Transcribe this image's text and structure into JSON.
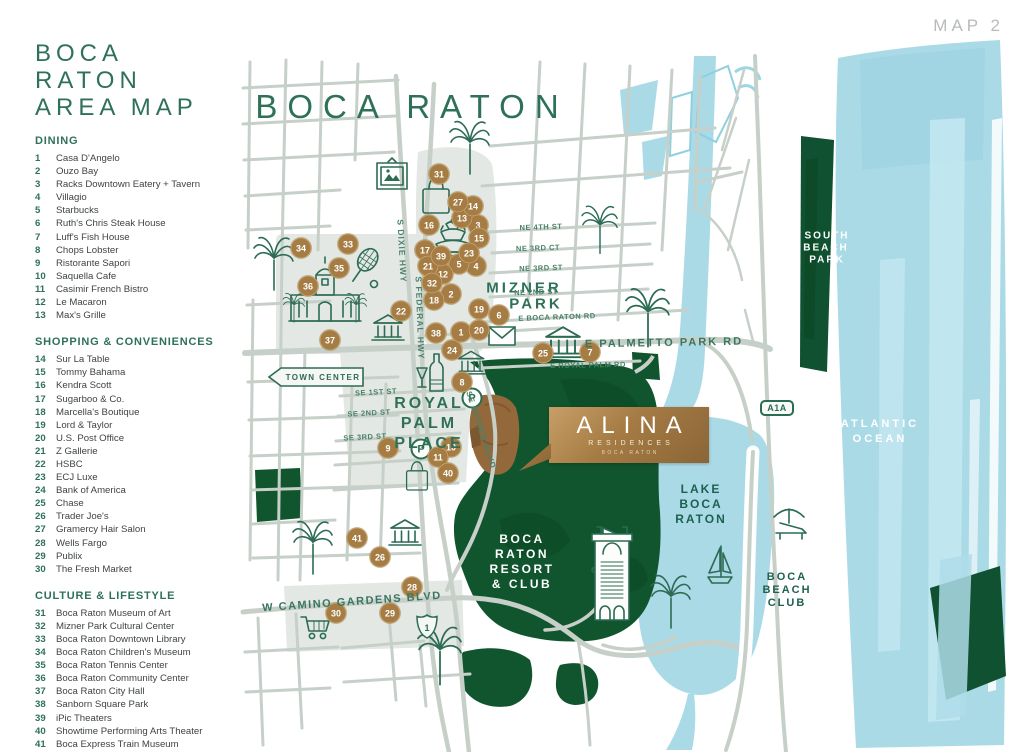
{
  "page": {
    "map_label": "MAP 2",
    "title_line1": "BOCA RATON",
    "title_line2": "AREA MAP"
  },
  "legend": {
    "sections": [
      {
        "heading": "DINING",
        "items": [
          {
            "num": "1",
            "label": "Casa D'Angelo"
          },
          {
            "num": "2",
            "label": "Ouzo Bay"
          },
          {
            "num": "3",
            "label": "Racks Downtown Eatery + Tavern"
          },
          {
            "num": "4",
            "label": "Villagio"
          },
          {
            "num": "5",
            "label": "Starbucks"
          },
          {
            "num": "6",
            "label": "Ruth's Chris Steak House"
          },
          {
            "num": "7",
            "label": "Luff's Fish House"
          },
          {
            "num": "8",
            "label": "Chops Lobster"
          },
          {
            "num": "9",
            "label": "Ristorante Sapori"
          },
          {
            "num": "10",
            "label": "Saquella Cafe"
          },
          {
            "num": "11",
            "label": "Casimir French Bistro"
          },
          {
            "num": "12",
            "label": "Le Macaron"
          },
          {
            "num": "13",
            "label": "Max's Grille"
          }
        ]
      },
      {
        "heading": "SHOPPING & CONVENIENCES",
        "items": [
          {
            "num": "14",
            "label": "Sur La Table"
          },
          {
            "num": "15",
            "label": "Tommy Bahama"
          },
          {
            "num": "16",
            "label": "Kendra Scott"
          },
          {
            "num": "17",
            "label": "Sugarboo & Co."
          },
          {
            "num": "18",
            "label": "Marcella's Boutique"
          },
          {
            "num": "19",
            "label": "Lord & Taylor"
          },
          {
            "num": "20",
            "label": "U.S. Post Office"
          },
          {
            "num": "21",
            "label": "Z Gallerie"
          },
          {
            "num": "22",
            "label": "HSBC"
          },
          {
            "num": "23",
            "label": "ECJ Luxe"
          },
          {
            "num": "24",
            "label": "Bank of America"
          },
          {
            "num": "25",
            "label": "Chase"
          },
          {
            "num": "26",
            "label": "Trader Joe's"
          },
          {
            "num": "27",
            "label": "Gramercy Hair Salon"
          },
          {
            "num": "28",
            "label": "Wells Fargo"
          },
          {
            "num": "29",
            "label": "Publix"
          },
          {
            "num": "30",
            "label": "The Fresh Market"
          }
        ]
      },
      {
        "heading": "CULTURE & LIFESTYLE",
        "items": [
          {
            "num": "31",
            "label": "Boca Raton Museum of Art"
          },
          {
            "num": "32",
            "label": "Mizner Park Cultural Center"
          },
          {
            "num": "33",
            "label": "Boca Raton Downtown Library"
          },
          {
            "num": "34",
            "label": "Boca Raton Children's Museum"
          },
          {
            "num": "35",
            "label": "Boca Raton Tennis Center"
          },
          {
            "num": "36",
            "label": "Boca Raton Community Center"
          },
          {
            "num": "37",
            "label": "Boca Raton City Hall"
          },
          {
            "num": "38",
            "label": "Sanborn Square Park"
          },
          {
            "num": "39",
            "label": "iPic Theaters"
          },
          {
            "num": "40",
            "label": "Showtime Performing Arts Theater"
          },
          {
            "num": "41",
            "label": "Boca Express Train Museum"
          }
        ]
      }
    ]
  },
  "map": {
    "town_center": "TOWN CENTER",
    "parking_label": "P",
    "badges": {
      "a1a": "A1A",
      "us1": "1"
    },
    "alina": {
      "name": "ALINA",
      "sub": "RESIDENCES",
      "city": "BOCA RATON"
    },
    "colors": {
      "accent_green": "#2e7158",
      "park_green": "#11552e",
      "water_blue": "#abdae7",
      "marker_bronze": "#a57c43",
      "alina_gold": "#a57b44",
      "road_gray": "#c6d0c8"
    },
    "labels": [
      {
        "t": "BOCA RATON",
        "x": 412,
        "y": 107,
        "s": 33,
        "ls": 10,
        "c": "city"
      },
      {
        "t": "MIZNER",
        "x": 524,
        "y": 288,
        "s": 15,
        "ls": 3,
        "c": "area"
      },
      {
        "t": "PARK",
        "x": 536,
        "y": 304,
        "s": 15,
        "ls": 3,
        "c": "area"
      },
      {
        "t": "ROYAL",
        "x": 429,
        "y": 404,
        "s": 16,
        "ls": 3,
        "c": "area"
      },
      {
        "t": "PALM",
        "x": 429,
        "y": 424,
        "s": 16,
        "ls": 3,
        "c": "area"
      },
      {
        "t": "PLACE",
        "x": 429,
        "y": 444,
        "s": 16,
        "ls": 3,
        "c": "area"
      },
      {
        "t": "BOCA",
        "x": 522,
        "y": 539,
        "s": 12,
        "ls": 2.5,
        "c": "wht"
      },
      {
        "t": "RATON",
        "x": 522,
        "y": 554,
        "s": 12,
        "ls": 2.5,
        "c": "wht"
      },
      {
        "t": "RESORT",
        "x": 522,
        "y": 569,
        "s": 12,
        "ls": 2.5,
        "c": "wht"
      },
      {
        "t": "& CLUB",
        "x": 522,
        "y": 584,
        "s": 12,
        "ls": 2.5,
        "c": "wht"
      },
      {
        "t": "LAKE",
        "x": 701,
        "y": 489,
        "s": 12,
        "ls": 2,
        "c": "lk"
      },
      {
        "t": "BOCA",
        "x": 701,
        "y": 504,
        "s": 12,
        "ls": 2,
        "c": "lk"
      },
      {
        "t": "RATON",
        "x": 701,
        "y": 519,
        "s": 12,
        "ls": 2,
        "c": "lk"
      },
      {
        "t": "SOUTH",
        "x": 827,
        "y": 236,
        "s": 10,
        "ls": 2,
        "c": "wht"
      },
      {
        "t": "BEACH",
        "x": 826,
        "y": 248,
        "s": 10,
        "ls": 2,
        "c": "wht"
      },
      {
        "t": "PARK",
        "x": 827,
        "y": 260,
        "s": 10,
        "ls": 2,
        "c": "wht"
      },
      {
        "t": "ATLANTIC",
        "x": 880,
        "y": 424,
        "s": 11,
        "ls": 3,
        "c": "wht"
      },
      {
        "t": "OCEAN",
        "x": 880,
        "y": 439,
        "s": 11,
        "ls": 3,
        "c": "wht"
      },
      {
        "t": "BOCA",
        "x": 787,
        "y": 577,
        "s": 11,
        "ls": 2,
        "c": "lk"
      },
      {
        "t": "BEACH",
        "x": 787,
        "y": 590,
        "s": 11,
        "ls": 2,
        "c": "lk"
      },
      {
        "t": "CLUB",
        "x": 787,
        "y": 603,
        "s": 11,
        "ls": 2,
        "c": "lk"
      },
      {
        "t": "S DIXIE HWY",
        "x": 402,
        "y": 251,
        "s": 8.5,
        "ls": 1,
        "r": 87,
        "c": "st"
      },
      {
        "t": "S FEDERAL HWY",
        "x": 420,
        "y": 318,
        "s": 8.5,
        "ls": 1,
        "r": 88,
        "c": "st"
      },
      {
        "t": "SE MIZNER BLVD",
        "x": 481,
        "y": 430,
        "s": 8,
        "ls": 1,
        "r": 72,
        "c": "st"
      },
      {
        "t": "NE 4TH ST",
        "x": 541,
        "y": 227,
        "s": 7.5,
        "ls": 0.5,
        "r": -2,
        "c": "st"
      },
      {
        "t": "NE 3RD CT",
        "x": 538,
        "y": 248,
        "s": 7.5,
        "ls": 0.5,
        "r": -2,
        "c": "st"
      },
      {
        "t": "NE 3RD ST",
        "x": 541,
        "y": 268,
        "s": 7.5,
        "ls": 0.5,
        "r": -2,
        "c": "st"
      },
      {
        "t": "NE 2ND ST",
        "x": 536,
        "y": 292,
        "s": 7.5,
        "ls": 0.5,
        "r": -2,
        "c": "st"
      },
      {
        "t": "E BOCA RATON RD",
        "x": 557,
        "y": 317,
        "s": 7.5,
        "ls": 0.5,
        "r": -2,
        "c": "st"
      },
      {
        "t": "E PALMETTO PARK RD",
        "x": 664,
        "y": 343,
        "s": 11,
        "ls": 2,
        "r": -1,
        "c": "stBig"
      },
      {
        "t": "E ROYAL PALM RD",
        "x": 588,
        "y": 365,
        "s": 7.5,
        "ls": 0.5,
        "r": -1,
        "c": "st"
      },
      {
        "t": "SE 1ST ST",
        "x": 376,
        "y": 392,
        "s": 7.5,
        "ls": 0.5,
        "r": -3,
        "c": "st"
      },
      {
        "t": "SE 2ND ST",
        "x": 369,
        "y": 413,
        "s": 7.5,
        "ls": 0.5,
        "r": -3,
        "c": "st"
      },
      {
        "t": "SE 3RD ST",
        "x": 365,
        "y": 437,
        "s": 7.5,
        "ls": 0.5,
        "r": -3,
        "c": "st"
      },
      {
        "t": "W CAMINO GARDENS BLVD",
        "x": 352,
        "y": 602,
        "s": 11,
        "ls": 1.5,
        "r": -4,
        "c": "stBig"
      }
    ],
    "markers": [
      {
        "n": "1",
        "x": 461,
        "y": 332
      },
      {
        "n": "2",
        "x": 451,
        "y": 294
      },
      {
        "n": "3",
        "x": 478,
        "y": 225
      },
      {
        "n": "4",
        "x": 476,
        "y": 266
      },
      {
        "n": "5",
        "x": 459,
        "y": 264
      },
      {
        "n": "6",
        "x": 499,
        "y": 315
      },
      {
        "n": "7",
        "x": 590,
        "y": 352
      },
      {
        "n": "8",
        "x": 462,
        "y": 382
      },
      {
        "n": "9",
        "x": 388,
        "y": 448
      },
      {
        "n": "10",
        "x": 451,
        "y": 447
      },
      {
        "n": "11",
        "x": 438,
        "y": 457
      },
      {
        "n": "12",
        "x": 443,
        "y": 274
      },
      {
        "n": "13",
        "x": 462,
        "y": 218
      },
      {
        "n": "14",
        "x": 473,
        "y": 206
      },
      {
        "n": "15",
        "x": 479,
        "y": 238
      },
      {
        "n": "16",
        "x": 429,
        "y": 225
      },
      {
        "n": "17",
        "x": 425,
        "y": 250
      },
      {
        "n": "18",
        "x": 434,
        "y": 300
      },
      {
        "n": "19",
        "x": 479,
        "y": 309
      },
      {
        "n": "20",
        "x": 479,
        "y": 330
      },
      {
        "n": "21",
        "x": 428,
        "y": 266
      },
      {
        "n": "22",
        "x": 401,
        "y": 311
      },
      {
        "n": "23",
        "x": 469,
        "y": 253
      },
      {
        "n": "24",
        "x": 452,
        "y": 350
      },
      {
        "n": "25",
        "x": 543,
        "y": 353
      },
      {
        "n": "26",
        "x": 380,
        "y": 557
      },
      {
        "n": "27",
        "x": 458,
        "y": 202
      },
      {
        "n": "28",
        "x": 412,
        "y": 587
      },
      {
        "n": "29",
        "x": 390,
        "y": 613
      },
      {
        "n": "30",
        "x": 336,
        "y": 613
      },
      {
        "n": "31",
        "x": 439,
        "y": 174
      },
      {
        "n": "32",
        "x": 432,
        "y": 283
      },
      {
        "n": "33",
        "x": 348,
        "y": 244
      },
      {
        "n": "34",
        "x": 301,
        "y": 248
      },
      {
        "n": "35",
        "x": 339,
        "y": 268
      },
      {
        "n": "36",
        "x": 308,
        "y": 286
      },
      {
        "n": "37",
        "x": 330,
        "y": 340
      },
      {
        "n": "38",
        "x": 436,
        "y": 333
      },
      {
        "n": "39",
        "x": 441,
        "y": 256
      },
      {
        "n": "40",
        "x": 448,
        "y": 473
      },
      {
        "n": "41",
        "x": 357,
        "y": 538
      }
    ]
  }
}
